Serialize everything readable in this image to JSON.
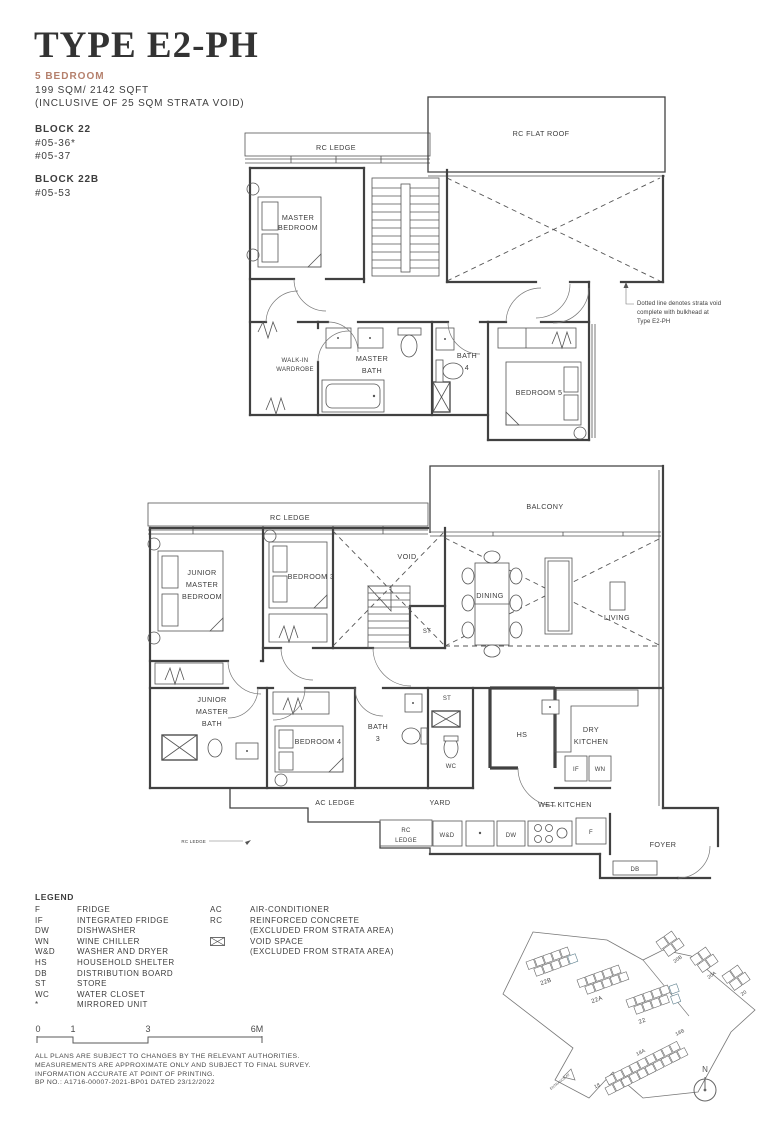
{
  "header": {
    "title": "TYPE E2-PH",
    "bedroom_type": "5 BEDROOM",
    "area": "199 SQM/ 2142 SQFT",
    "area_note": "(INCLUSIVE OF 25 SQM STRATA VOID)",
    "block1_name": "BLOCK 22",
    "block1_unit1": "#05-36*",
    "block1_unit2": "#05-37",
    "block2_name": "BLOCK 22B",
    "block2_unit1": "#05-53"
  },
  "colors": {
    "accent": "#b5806c",
    "line": "#414141",
    "highlight": "#9fbecb"
  },
  "upper_plan": {
    "labels": {
      "rc_ledge": "RC LEDGE",
      "rc_flat_roof": "RC FLAT ROOF",
      "master_bedroom_1": "MASTER",
      "master_bedroom_2": "BEDROOM",
      "walk_in_1": "WALK-IN",
      "walk_in_2": "WARDROBE",
      "master_bath_1": "MASTER",
      "master_bath_2": "BATH",
      "bath4_1": "BATH",
      "bath4_2": "4",
      "bedroom5": "BEDROOM 5"
    },
    "note_1": "Dotted line denotes strata void",
    "note_2": "complete with bulkhead at",
    "note_3": "Type E2-PH"
  },
  "lower_plan": {
    "labels": {
      "rc_ledge": "RC LEDGE",
      "balcony": "BALCONY",
      "jmb_1": "JUNIOR",
      "jmb_2": "MASTER",
      "jmb_3": "BEDROOM",
      "bedroom3": "BEDROOM 3",
      "void": "VOID",
      "st_top": "ST",
      "dining": "DINING",
      "living": "LIVING",
      "jmbath_1": "JUNIOR",
      "jmbath_2": "MASTER",
      "jmbath_3": "BATH",
      "bedroom4": "BEDROOM 4",
      "bath3_1": "BATH",
      "bath3_2": "3",
      "st_mid": "ST",
      "wc": "WC",
      "hs": "HS",
      "dry_kitchen_1": "DRY",
      "dry_kitchen_2": "KITCHEN",
      "if": "IF",
      "wn": "WN",
      "ac_ledge": "AC LEDGE",
      "yard": "YARD",
      "wet_kitchen": "WET KITCHEN",
      "rc_ledge_sm_1": "RC",
      "rc_ledge_sm_2": "LEDGE",
      "wd": "W&D",
      "dw": "DW",
      "f": "F",
      "foyer": "FOYER",
      "db": "DB",
      "rc_ledge_callout": "RC LEDGE"
    }
  },
  "legend": {
    "title": "LEGEND",
    "items_left": [
      {
        "abbr": "F",
        "label": "FRIDGE"
      },
      {
        "abbr": "IF",
        "label": "INTEGRATED FRIDGE"
      },
      {
        "abbr": "DW",
        "label": "DISHWASHER"
      },
      {
        "abbr": "WN",
        "label": "WINE CHILLER"
      },
      {
        "abbr": "W&D",
        "label": "WASHER AND DRYER"
      },
      {
        "abbr": "HS",
        "label": "HOUSEHOLD SHELTER"
      },
      {
        "abbr": "DB",
        "label": "DISTRIBUTION BOARD"
      },
      {
        "abbr": "ST",
        "label": "STORE"
      },
      {
        "abbr": "WC",
        "label": "WATER CLOSET"
      },
      {
        "abbr": "*",
        "label": "MIRRORED UNIT"
      }
    ],
    "items_right": [
      {
        "abbr": "AC",
        "label": "AIR-CONDITIONER"
      },
      {
        "abbr": "RC",
        "label": "REINFORCED CONCRETE"
      },
      {
        "abbr": "",
        "label": "(EXCLUDED FROM STRATA AREA)"
      },
      {
        "abbr": "",
        "label": "VOID SPACE"
      },
      {
        "abbr": "",
        "label": "(EXCLUDED FROM STRATA AREA)"
      }
    ]
  },
  "scale_bar": {
    "labels": [
      "0",
      "1",
      "3",
      "6M"
    ]
  },
  "notes": [
    "ALL PLANS ARE SUBJECT TO CHANGES BY THE RELEVANT AUTHORITIES.",
    "MEASUREMENTS ARE APPROXIMATE ONLY AND SUBJECT TO FINAL SURVEY.",
    "INFORMATION ACCURATE AT POINT OF PRINTING.",
    "BP NO.: A1716-00007-2021-BP01 DATED 23/12/2022"
  ],
  "site_plan": {
    "block_labels": [
      "22B",
      "22A",
      "22",
      "20B",
      "20A",
      "20",
      "18B",
      "18A",
      "18"
    ],
    "compass_label": "N",
    "entrance_label": "ENTRANCE AT"
  }
}
